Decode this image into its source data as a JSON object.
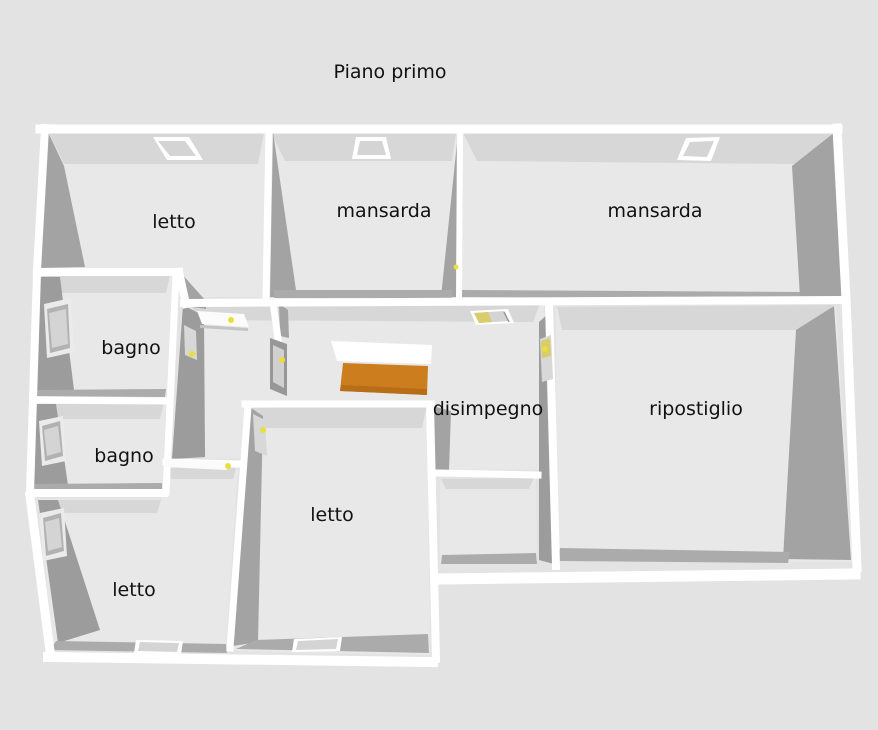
{
  "title": {
    "text": "Piano primo"
  },
  "rooms": [
    {
      "id": "letto-top-left",
      "label": "letto",
      "x": 174,
      "y": 222
    },
    {
      "id": "mansarda-middle",
      "label": "mansarda",
      "x": 384,
      "y": 211
    },
    {
      "id": "mansarda-right",
      "label": "mansarda",
      "x": 655,
      "y": 211
    },
    {
      "id": "bagno-1",
      "label": "bagno",
      "x": 131,
      "y": 348
    },
    {
      "id": "bagno-2",
      "label": "bagno",
      "x": 124,
      "y": 456
    },
    {
      "id": "letto-bottom-left",
      "label": "letto",
      "x": 134,
      "y": 590
    },
    {
      "id": "letto-bottom-center",
      "label": "letto",
      "x": 332,
      "y": 515
    },
    {
      "id": "disimpegno",
      "label": "disimpegno",
      "x": 488,
      "y": 409
    },
    {
      "id": "ripostiglio",
      "label": "ripostiglio",
      "x": 696,
      "y": 409
    }
  ],
  "colors": {
    "background": "#e3e3e3",
    "floor": "#e8e8e8",
    "wall_cap": "#ffffff",
    "wall_face": "#a3a3a3",
    "wall_face_dark": "#9c9c9c",
    "wall_strip": "#d7d7d7",
    "wall_band": "#ababab",
    "stair": "#cc7d1e",
    "stair_shadow": "#b86d18",
    "door_handle": "#e8df3c",
    "label_text": "#111111"
  }
}
